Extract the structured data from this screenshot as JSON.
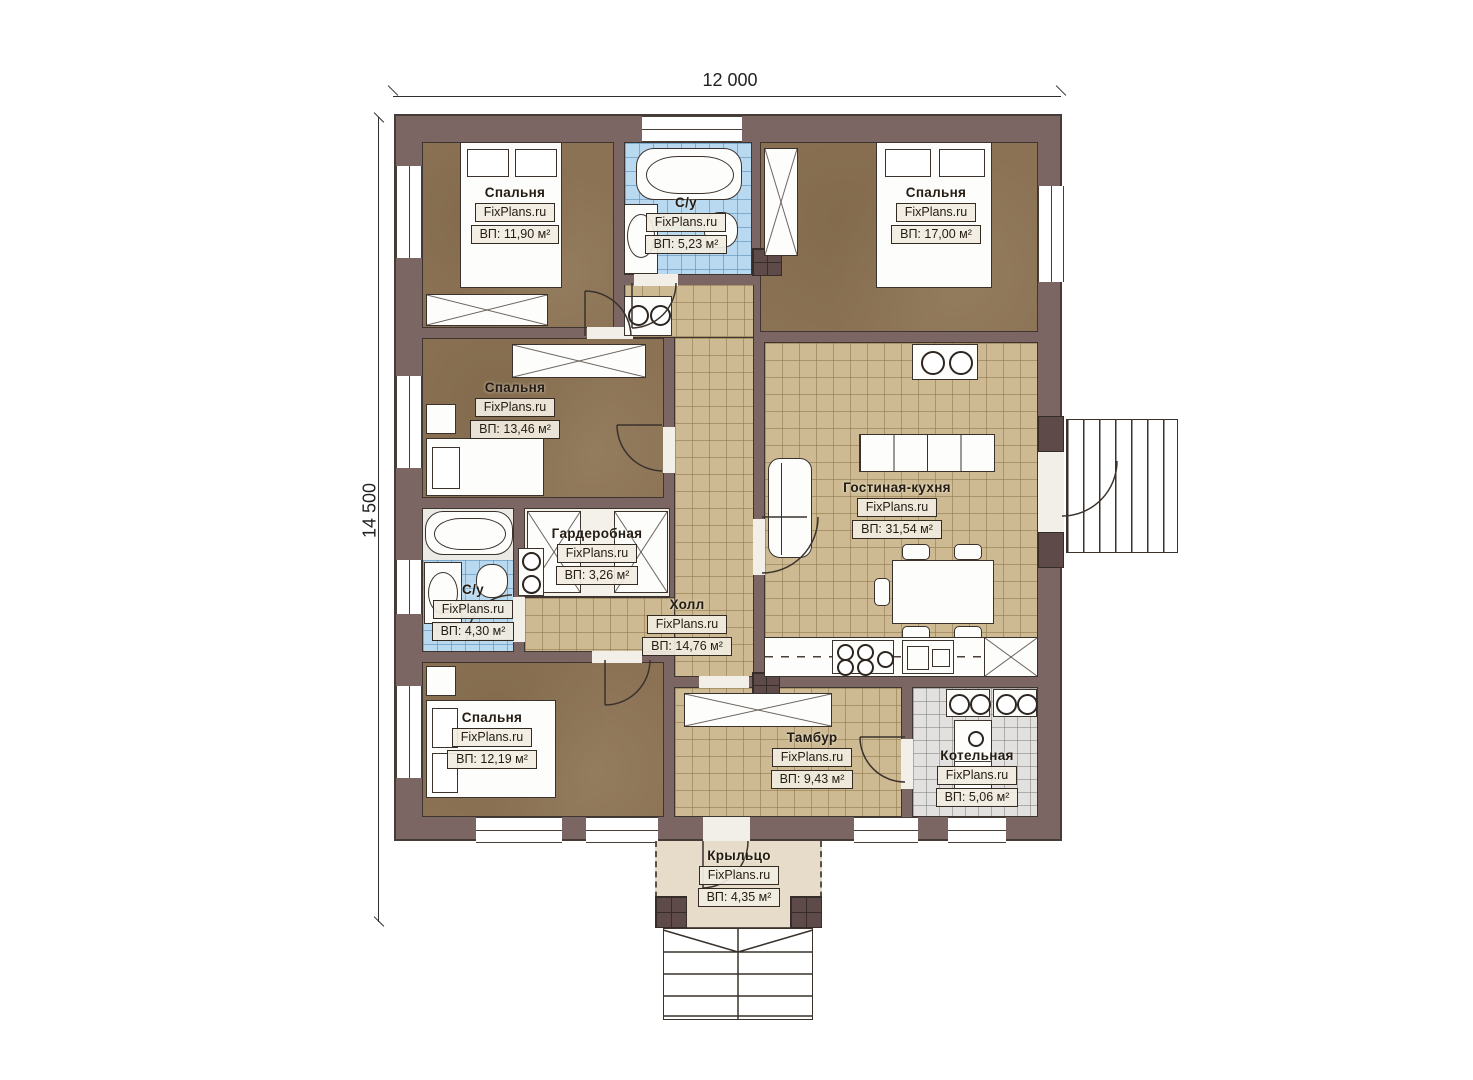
{
  "plan": {
    "title": "Одноэтажный дом — план этажа",
    "watermark": "FixPlans.ru",
    "dimensions": {
      "width_label": "12 000",
      "height_label": "14 500"
    },
    "rooms": [
      {
        "id": "bedroom-1",
        "name": "Спальня",
        "area": "ВП: 11,90 м²"
      },
      {
        "id": "bathroom-top",
        "name": "С/у",
        "area": "ВП: 5,23 м²"
      },
      {
        "id": "bedroom-2",
        "name": "Спальня",
        "area": "ВП: 17,00 м²"
      },
      {
        "id": "bedroom-3",
        "name": "Спальня",
        "area": "ВП: 13,46 м²"
      },
      {
        "id": "wardrobe",
        "name": "Гардеробная",
        "area": "ВП: 3,26 м²"
      },
      {
        "id": "bathroom-left",
        "name": "С/у",
        "area": "ВП: 4,30 м²"
      },
      {
        "id": "bedroom-4",
        "name": "Спальня",
        "area": "ВП: 12,19 м²"
      },
      {
        "id": "hall",
        "name": "Холл",
        "area": "ВП: 14,76 м²"
      },
      {
        "id": "living-kitchen",
        "name": "Гостиная-кухня",
        "area": "ВП: 31,54 м²"
      },
      {
        "id": "vestibule",
        "name": "Тамбур",
        "area": "ВП: 9,43 м²"
      },
      {
        "id": "boiler-room",
        "name": "Котельная",
        "area": "ВП: 5,06 м²"
      },
      {
        "id": "porch",
        "name": "Крыльцо",
        "area": "ВП: 4,35 м²"
      }
    ]
  },
  "colors": {
    "wall": "#7b6663",
    "outline": "#3f3530",
    "bed-floor": "#8b7254"
  }
}
